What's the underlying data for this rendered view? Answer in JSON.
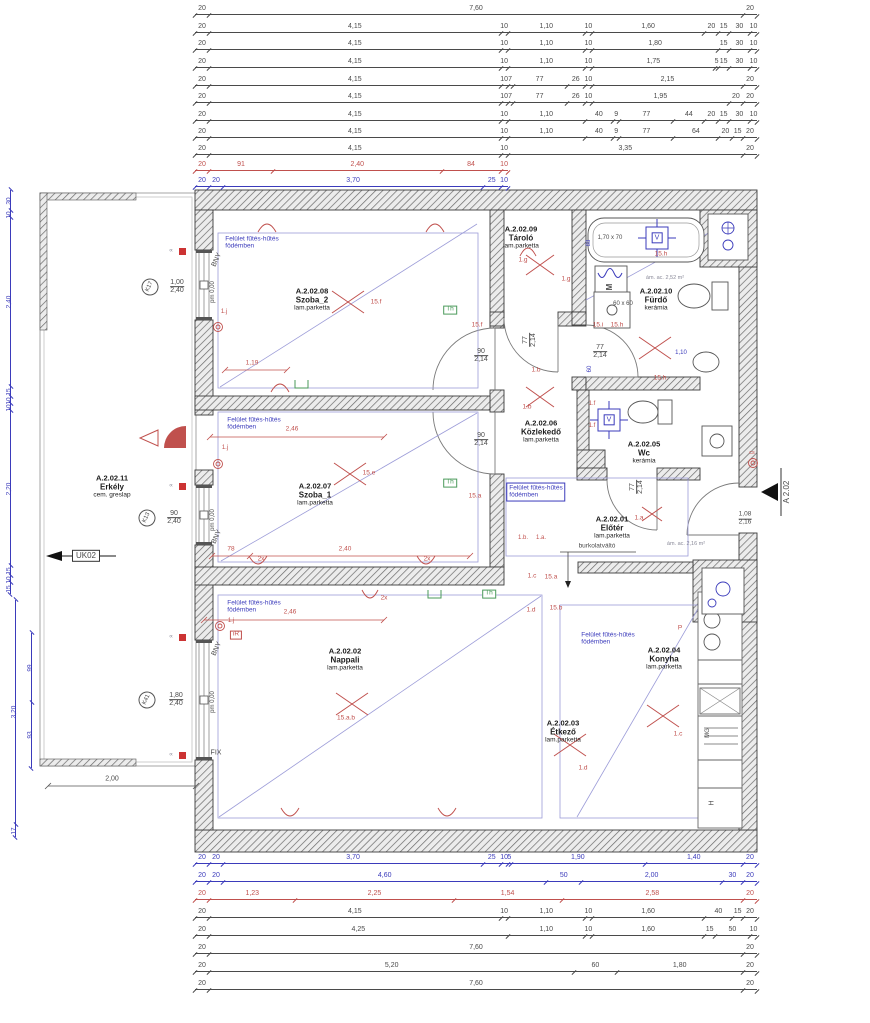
{
  "colors": {
    "k": "#4a4a4a",
    "r": "#c0504d",
    "b": "#3b3bbb",
    "g": "#8a8a99",
    "gn": "#4a9a5a"
  },
  "plan": {
    "rooms": [
      {
        "id": "A.2.02.08",
        "name": "Szoba_2",
        "finish": "lam.parketta",
        "x": 312,
        "y": 299
      },
      {
        "id": "A.2.02.09",
        "name": "Tároló",
        "finish": "lam.parketta",
        "x": 521,
        "y": 237
      },
      {
        "id": "A.2.02.10",
        "name": "Fürdő",
        "finish": "kerámia",
        "x": 656,
        "y": 299
      },
      {
        "id": "A.2.02.06",
        "name": "Közlekedő",
        "finish": "lam.parketta",
        "x": 541,
        "y": 431
      },
      {
        "id": "A.2.02.07",
        "name": "Szoba_1",
        "finish": "lam.parketta",
        "x": 315,
        "y": 494
      },
      {
        "id": "A.2.02.05",
        "name": "Wc",
        "finish": "kerámia",
        "x": 644,
        "y": 452
      },
      {
        "id": "A.2.02.01",
        "name": "Előtér",
        "finish": "lam.parketta",
        "x": 612,
        "y": 527
      },
      {
        "id": "A.2.02.02",
        "name": "Nappali",
        "finish": "lam.parketta",
        "x": 345,
        "y": 659
      },
      {
        "id": "A.2.02.03",
        "name": "Étkező",
        "finish": "lam.parketta",
        "x": 563,
        "y": 731
      },
      {
        "id": "A.2.02.04",
        "name": "Konyha",
        "finish": "lam.parketta",
        "x": 664,
        "y": 658
      },
      {
        "id": "A.2.02.11",
        "name": "Erkély",
        "finish": "cem. greslap",
        "x": 112,
        "y": 486
      }
    ],
    "heating_note_lines": [
      "Felület fűtés-hűtés",
      "födémben"
    ],
    "heating_notes": [
      {
        "x": 252,
        "y": 243,
        "boxed": false
      },
      {
        "x": 254,
        "y": 424,
        "boxed": false
      },
      {
        "x": 536,
        "y": 492,
        "boxed": true
      },
      {
        "x": 254,
        "y": 607,
        "boxed": false
      },
      {
        "x": 608,
        "y": 639,
        "boxed": false
      }
    ],
    "labels": [
      {
        "t": "BNY",
        "x": 217,
        "y": 260,
        "c": "k",
        "fs": 7,
        "rot": -65
      },
      {
        "t": "BNY",
        "x": 217,
        "y": 537,
        "c": "k",
        "fs": 7,
        "rot": -65
      },
      {
        "t": "BNY",
        "x": 217,
        "y": 649,
        "c": "k",
        "fs": 7,
        "rot": -65
      },
      {
        "t": "pm 0,00",
        "x": 213,
        "y": 292,
        "c": "k",
        "fs": 6,
        "rot": -90
      },
      {
        "t": "pm 0,00",
        "x": 213,
        "y": 520,
        "c": "k",
        "fs": 6,
        "rot": -90
      },
      {
        "t": "pm 0,00",
        "x": 213,
        "y": 702,
        "c": "k",
        "fs": 6,
        "rot": -90
      },
      {
        "t": "FIX",
        "x": 216,
        "y": 753,
        "c": "k",
        "fs": 7
      },
      {
        "t": "2,00",
        "x": 112,
        "y": 779,
        "c": "k",
        "fs": 7
      },
      {
        "t": "1,19",
        "x": 252,
        "y": 364,
        "c": "r",
        "fs": 6.5
      },
      {
        "t": "2,46",
        "x": 292,
        "y": 430,
        "c": "r",
        "fs": 6.5
      },
      {
        "t": "2,46",
        "x": 290,
        "y": 613,
        "c": "r",
        "fs": 6.5
      },
      {
        "t": "78",
        "x": 231,
        "y": 550,
        "c": "r",
        "fs": 6.5
      },
      {
        "t": "2,40",
        "x": 345,
        "y": 550,
        "c": "r",
        "fs": 6.5
      },
      {
        "t": "2x",
        "x": 261,
        "y": 560,
        "c": "r",
        "fs": 6.5
      },
      {
        "t": "2x",
        "x": 427,
        "y": 560,
        "c": "r",
        "fs": 6.5
      },
      {
        "t": "2x",
        "x": 384,
        "y": 599,
        "c": "r",
        "fs": 6.5
      },
      {
        "t": "15.f",
        "x": 376,
        "y": 303,
        "c": "r",
        "fs": 6.5
      },
      {
        "t": "15.f",
        "x": 477,
        "y": 326,
        "c": "r",
        "fs": 6.5
      },
      {
        "t": "15.e",
        "x": 369,
        "y": 474,
        "c": "r",
        "fs": 6.5
      },
      {
        "t": "15.a",
        "x": 475,
        "y": 497,
        "c": "r",
        "fs": 6.5
      },
      {
        "t": "15.a.b",
        "x": 346,
        "y": 719,
        "c": "r",
        "fs": 6.5
      },
      {
        "t": "1.g",
        "x": 523,
        "y": 261,
        "c": "r",
        "fs": 6.5
      },
      {
        "t": "1.g",
        "x": 566,
        "y": 280,
        "c": "r",
        "fs": 6.5
      },
      {
        "t": "1.b",
        "x": 536,
        "y": 371,
        "c": "r",
        "fs": 6.5
      },
      {
        "t": "1.b",
        "x": 527,
        "y": 408,
        "c": "r",
        "fs": 6.5
      },
      {
        "t": "1.b.",
        "x": 523,
        "y": 538,
        "c": "r",
        "fs": 6
      },
      {
        "t": "1.a.",
        "x": 541,
        "y": 538,
        "c": "r",
        "fs": 6
      },
      {
        "t": "15.h",
        "x": 661,
        "y": 255,
        "c": "r",
        "fs": 6.5
      },
      {
        "t": "15.i",
        "x": 598,
        "y": 326,
        "c": "r",
        "fs": 6.5
      },
      {
        "t": "15.h",
        "x": 617,
        "y": 326,
        "c": "r",
        "fs": 6.5
      },
      {
        "t": "15.h.",
        "x": 661,
        "y": 379,
        "c": "r",
        "fs": 6.5
      },
      {
        "t": "1.f",
        "x": 592,
        "y": 404,
        "c": "r",
        "fs": 6
      },
      {
        "t": "1.f",
        "x": 592,
        "y": 426,
        "c": "r",
        "fs": 6
      },
      {
        "t": "1.a",
        "x": 639,
        "y": 519,
        "c": "r",
        "fs": 6.5
      },
      {
        "t": "15.a",
        "x": 551,
        "y": 578,
        "c": "r",
        "fs": 6.5
      },
      {
        "t": "1.c",
        "x": 532,
        "y": 577,
        "c": "r",
        "fs": 6.5
      },
      {
        "t": "15.b",
        "x": 556,
        "y": 609,
        "c": "r",
        "fs": 6.5
      },
      {
        "t": "1.d",
        "x": 531,
        "y": 611,
        "c": "r",
        "fs": 6.5
      },
      {
        "t": "1.d",
        "x": 583,
        "y": 769,
        "c": "r",
        "fs": 6.5
      },
      {
        "t": "1.c",
        "x": 678,
        "y": 735,
        "c": "r",
        "fs": 6.5
      },
      {
        "t": "P",
        "x": 680,
        "y": 629,
        "c": "r",
        "fs": 6.5
      },
      {
        "t": "iR",
        "x": 236,
        "y": 635,
        "c": "r",
        "fs": 6.5,
        "box": "r"
      },
      {
        "t": "1.j",
        "x": 224,
        "y": 312,
        "c": "r",
        "fs": 6
      },
      {
        "t": "1.j",
        "x": 225,
        "y": 448,
        "c": "r",
        "fs": 6
      },
      {
        "t": "1.j",
        "x": 231,
        "y": 621,
        "c": "r",
        "fs": 6
      },
      {
        "t": "Th",
        "x": 450,
        "y": 310,
        "c": "gn",
        "fs": 6.5,
        "box": "g"
      },
      {
        "t": "Th",
        "x": 450,
        "y": 483,
        "c": "gn",
        "fs": 6.5,
        "box": "g"
      },
      {
        "t": "Th",
        "x": 489,
        "y": 594,
        "c": "gn",
        "fs": 6.5,
        "box": "g"
      },
      {
        "t": "M",
        "x": 610,
        "y": 287,
        "c": "k",
        "fs": 8,
        "rot": -90,
        "fw": "bold"
      },
      {
        "t": "1,70 x 70",
        "x": 610,
        "y": 238,
        "c": "k",
        "fs": 6
      },
      {
        "t": "60 x 60",
        "x": 623,
        "y": 304,
        "c": "k",
        "fs": 6
      },
      {
        "t": "ám. ac. 2,52 m²",
        "x": 665,
        "y": 279,
        "c": "g",
        "fs": 5.5
      },
      {
        "t": "ám. ac. 2,16 m²",
        "x": 686,
        "y": 545,
        "c": "g",
        "fs": 5.5
      },
      {
        "t": "burkolatváltó",
        "x": 597,
        "y": 547,
        "c": "k",
        "fs": 6.5
      },
      {
        "t": "V",
        "x": 657,
        "y": 238,
        "c": "b",
        "fs": 7,
        "box": "b"
      },
      {
        "t": "V",
        "x": 609,
        "y": 420,
        "c": "b",
        "fs": 7,
        "box": "b"
      },
      {
        "t": "MG",
        "x": 708,
        "y": 733,
        "c": "k",
        "fs": 6,
        "rot": -90
      },
      {
        "t": "H",
        "x": 712,
        "y": 803,
        "c": "k",
        "fs": 7,
        "rot": -90
      },
      {
        "t": "cs",
        "x": 752,
        "y": 454,
        "c": "r",
        "fs": 5.5
      },
      {
        "t": "UK02",
        "x": 86,
        "y": 556,
        "c": "k",
        "fs": 8,
        "box": "k",
        "n": "section-label-uk02"
      },
      {
        "t": "A 2.02",
        "x": 787,
        "y": 492,
        "c": "k",
        "fs": 8,
        "rot": -90,
        "n": "section-label-a202"
      },
      {
        "t": "88",
        "x": 589,
        "y": 243,
        "c": "b",
        "fs": 6,
        "rot": -90
      },
      {
        "t": "60",
        "x": 590,
        "y": 369,
        "c": "b",
        "fs": 6,
        "rot": -90
      },
      {
        "t": "1,10",
        "x": 681,
        "y": 353,
        "c": "b",
        "fs": 6
      },
      {
        "t": "∝",
        "x": 171,
        "y": 251,
        "c": "g",
        "fs": 6
      },
      {
        "t": "∝",
        "x": 171,
        "y": 486,
        "c": "g",
        "fs": 6
      },
      {
        "t": "∝",
        "x": 171,
        "y": 637,
        "c": "g",
        "fs": 6
      },
      {
        "t": "∝",
        "x": 171,
        "y": 755,
        "c": "g",
        "fs": 6
      },
      {
        "t": "90",
        "t2": "2,14",
        "x": 481,
        "y": 356,
        "c": "k",
        "fs": 7,
        "n": "door-size"
      },
      {
        "t": "90",
        "t2": "2,14",
        "x": 481,
        "y": 440,
        "c": "k",
        "fs": 7,
        "n": "door-size"
      },
      {
        "t": "77",
        "t2": "2,14",
        "x": 530,
        "y": 340,
        "c": "k",
        "fs": 7,
        "rot": -90,
        "n": "door-size"
      },
      {
        "t": "77",
        "t2": "2,14",
        "x": 600,
        "y": 352,
        "c": "k",
        "fs": 7,
        "n": "door-size"
      },
      {
        "t": "77",
        "t2": "2,14",
        "x": 637,
        "y": 487,
        "c": "k",
        "fs": 7,
        "rot": -90,
        "n": "door-size"
      },
      {
        "t": "1,08",
        "t2": "2,16",
        "x": 745,
        "y": 519,
        "c": "k",
        "fs": 6.5,
        "n": "entrance-door-size"
      },
      {
        "t": "1,00",
        "t2": "2,40",
        "x": 177,
        "y": 287,
        "c": "k",
        "fs": 7,
        "n": "window-size"
      },
      {
        "t": "90",
        "t2": "2,40",
        "x": 174,
        "y": 518,
        "c": "k",
        "fs": 7,
        "n": "window-size"
      },
      {
        "t": "1,80",
        "t2": "2,40",
        "x": 176,
        "y": 700,
        "c": "k",
        "fs": 7,
        "n": "window-size"
      },
      {
        "t": "K17",
        "x": 150,
        "y": 287,
        "c": "k",
        "fs": 6,
        "circle": true,
        "rot": -65,
        "n": "window-mark-k17"
      },
      {
        "t": "K13",
        "x": 147,
        "y": 518,
        "c": "k",
        "fs": 6,
        "circle": true,
        "rot": -65,
        "n": "window-mark-k13"
      },
      {
        "t": "K41",
        "x": 147,
        "y": 700,
        "c": "k",
        "fs": 6,
        "circle": true,
        "rot": -65,
        "n": "window-mark-k41"
      }
    ]
  },
  "dimensions": {
    "top": [
      {
        "y": 14,
        "c": "k",
        "s": [
          "20",
          "7,60",
          "20"
        ]
      },
      {
        "y": 32,
        "c": "k",
        "s": [
          "20",
          "4,15",
          "10",
          "1,10",
          "10",
          "1,60",
          "20",
          "15",
          "30",
          "10"
        ]
      },
      {
        "y": 49,
        "c": "k",
        "s": [
          "20",
          "4,15",
          "10",
          "1,10",
          "10",
          "1,80",
          "15",
          "30",
          "10"
        ]
      },
      {
        "y": 67,
        "c": "k",
        "s": [
          "20",
          "4,15",
          "10",
          "1,10",
          "10",
          "1,75",
          "5",
          "15",
          "30",
          "10"
        ]
      },
      {
        "y": 85,
        "c": "k",
        "s": [
          "20",
          "4,15",
          "10",
          "7",
          "77",
          "26",
          "10",
          "2,15",
          "20"
        ]
      },
      {
        "y": 102,
        "c": "k",
        "s": [
          "20",
          "4,15",
          "10",
          "7",
          "77",
          "26",
          "10",
          "1,95",
          "20",
          "20"
        ]
      },
      {
        "y": 120,
        "c": "k",
        "s": [
          "20",
          "4,15",
          "10",
          "1,10",
          "40",
          "9",
          "77",
          "44",
          "20",
          "15",
          "30",
          "10"
        ]
      },
      {
        "y": 137,
        "c": "k",
        "s": [
          "20",
          "4,15",
          "10",
          "1,10",
          "40",
          "9",
          "77",
          "64",
          "20",
          "15",
          "20"
        ]
      },
      {
        "y": 154,
        "c": "k",
        "s": [
          "20",
          "4,15",
          "10",
          "3,35",
          "20"
        ]
      },
      {
        "y": 170,
        "c": "r",
        "s": [
          "20",
          "91",
          "2,40",
          "84",
          "10"
        ]
      },
      {
        "y": 186,
        "c": "b",
        "s": [
          "20",
          "20",
          "3,70",
          "25",
          "10"
        ]
      }
    ],
    "bottom": [
      {
        "y": 863,
        "c": "b",
        "s": [
          "20",
          "20",
          "3,70",
          "25",
          "10",
          "5",
          "1,90",
          "1,40",
          "20"
        ]
      },
      {
        "y": 881,
        "c": "b",
        "s": [
          "20",
          "20",
          "4,60",
          "50",
          "2,00",
          "30",
          "20"
        ]
      },
      {
        "y": 899,
        "c": "r",
        "s": [
          "20",
          "1,23",
          "2,25",
          "1,54",
          "2,58",
          "20"
        ]
      },
      {
        "y": 917,
        "c": "k",
        "s": [
          "20",
          "4,15",
          "10",
          "1,10",
          "10",
          "1,60",
          "40",
          "15",
          "20"
        ]
      },
      {
        "y": 935,
        "c": "k",
        "s": [
          "20",
          "4,25",
          "1,10",
          "10",
          "1,60",
          "15",
          "50",
          "10"
        ]
      },
      {
        "y": 953,
        "c": "k",
        "s": [
          "20",
          "7,60",
          "20"
        ]
      },
      {
        "y": 971,
        "c": "k",
        "s": [
          "20",
          "5,20",
          "60",
          "1,80",
          "20"
        ]
      },
      {
        "y": 989,
        "c": "k",
        "s": [
          "20",
          "7,60",
          "20"
        ]
      }
    ],
    "cols": [
      {
        "x": 10,
        "y": 190,
        "c": "b",
        "s": [
          "30",
          "10",
          "2,40",
          "15",
          "10",
          "10",
          "2,20",
          "15",
          "10",
          "15"
        ]
      },
      {
        "x": 15,
        "y": 600,
        "c": "b",
        "s": [
          "3,20",
          "17"
        ]
      },
      {
        "x": 31,
        "y": 633,
        "c": "b",
        "s": [
          "99",
          "93"
        ]
      }
    ]
  }
}
